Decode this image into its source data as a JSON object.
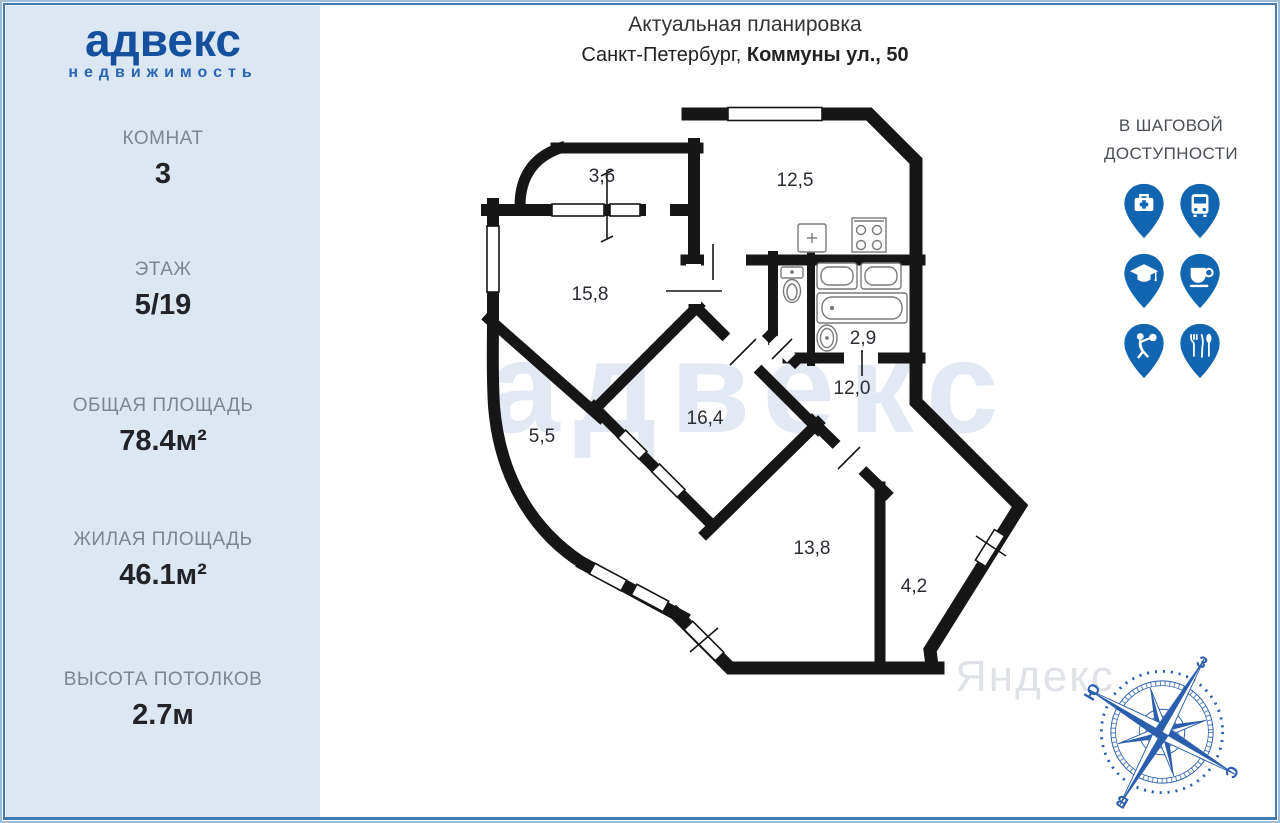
{
  "sidebar": {
    "logo_title": "адвекс",
    "logo_subtitle": "недвижимость",
    "stats": [
      {
        "label": "КОМНАТ",
        "value": "3"
      },
      {
        "label": "ЭТАЖ",
        "value": "5/19"
      },
      {
        "label": "ОБЩАЯ ПЛОЩАДЬ",
        "value": "78.4м²"
      },
      {
        "label": "ЖИЛАЯ ПЛОЩАДЬ",
        "value": "46.1м²"
      },
      {
        "label": "ВЫСОТА ПОТОЛКОВ",
        "value": "2.7м"
      }
    ]
  },
  "header": {
    "title": "Актуальная планировка",
    "city_prefix": "Санкт-Петербург, ",
    "address_bold": "Коммуны ул., 50"
  },
  "nearby": {
    "line1": "В ШАГОВОЙ",
    "line2": "ДОСТУПНОСТИ",
    "pins": [
      {
        "name": "medical"
      },
      {
        "name": "transport"
      },
      {
        "name": "education"
      },
      {
        "name": "cafe"
      },
      {
        "name": "fitness"
      },
      {
        "name": "restaurant"
      }
    ]
  },
  "plan": {
    "watermark": "адвекс",
    "rooms": [
      {
        "name": "balcony-small",
        "area": "3,6"
      },
      {
        "name": "kitchen",
        "area": "12,5"
      },
      {
        "name": "living-room",
        "area": "15,8"
      },
      {
        "name": "bathroom",
        "area": "2,9"
      },
      {
        "name": "hallway",
        "area": "12,0"
      },
      {
        "name": "balcony-large",
        "area": "5,5"
      },
      {
        "name": "room-16",
        "area": "16,4"
      },
      {
        "name": "room-13",
        "area": "13,8"
      },
      {
        "name": "room-4",
        "area": "4,2"
      }
    ]
  },
  "compass": {
    "north": "С",
    "south": "Ю",
    "east": "В",
    "west": "З"
  },
  "background_watermark": "Яндекс",
  "colors": {
    "brand_blue": "#15509f",
    "pin_blue": "#1266b1",
    "sidebar_bg": "#dbe7f2",
    "wall": "#161616",
    "compass_blue": "#2b5fad",
    "watermark_blue": "#2b5faa"
  }
}
